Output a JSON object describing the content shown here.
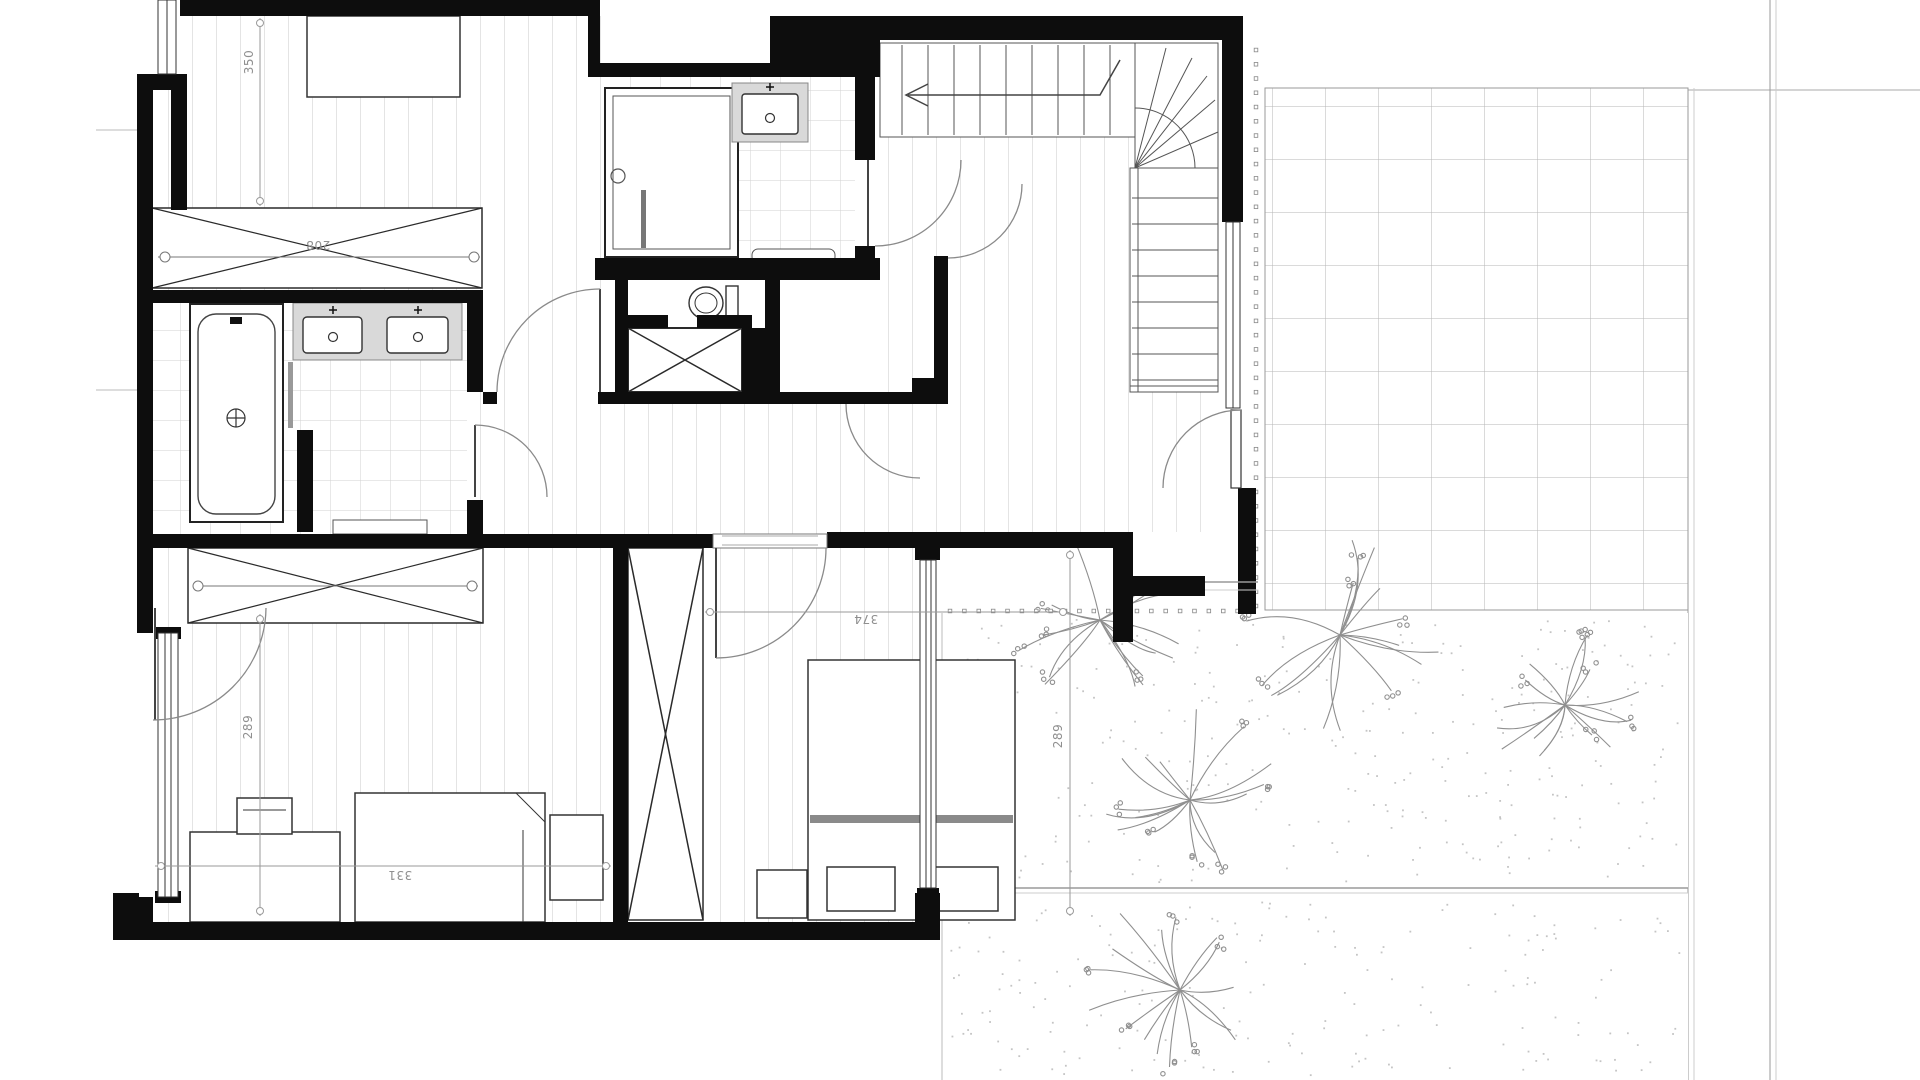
{
  "plan": {
    "dims": {
      "d350": "350",
      "d208": "208",
      "d374": "374",
      "d331": "331",
      "d289_left": "289",
      "d289_right": "289"
    },
    "colors": {
      "wall": "#0d0d0d",
      "fixture_line": "#333333",
      "floor_line": "#c9c9c9",
      "tile_line": "#d2d2d2",
      "terrace_line": "#b5b5b5",
      "counter_fill": "#d9d9d9",
      "headboard": "#8a8a8a",
      "dim_line": "#9a9a9a",
      "plant": "#8f8f8f",
      "stipple": "#c4c4c4"
    },
    "fixtures": [
      "bathtub-icon",
      "double-washbasin-icon",
      "washbasin-icon",
      "shower-icon",
      "toilet-icon",
      "staircase-icon",
      "double-bed-icon",
      "single-bed-icon",
      "desk-icon",
      "chair-icon",
      "nightstand-icon",
      "wardrobe-icon",
      "duct-shaft-icon",
      "door-swing-icon",
      "window-icon",
      "plant-icon"
    ]
  }
}
